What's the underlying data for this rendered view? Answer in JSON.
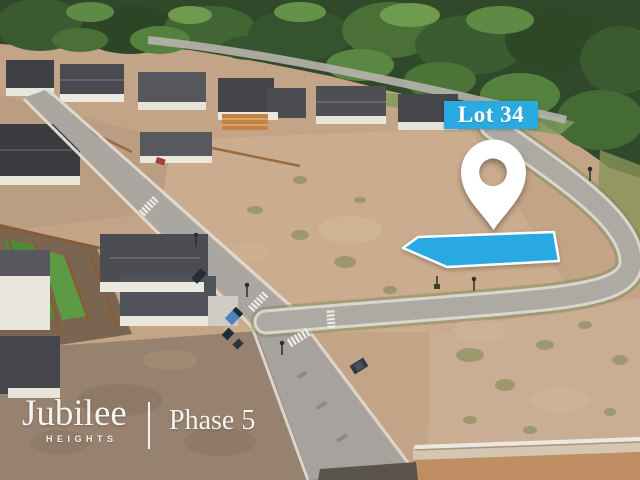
{
  "overlay": {
    "lot_label": "Lot 34",
    "marker": "location-pin"
  },
  "branding": {
    "name": "Jubilee",
    "subtitle": "HEIGHTS",
    "phase": "Phase 5"
  },
  "colors": {
    "highlight_blue": "#29a9e1",
    "label_blue": "#2baae1",
    "label_text": "#ffffff",
    "marker_white": "#ffffff",
    "brand_white": "#f5f3ee"
  },
  "scene": {
    "description": "Aerial drone photo of a residential subdivision under development: forested hillside at top, a row of finished homes, curving new roads with crosswalks, and graded empty dirt lots; Lot 34 is highlighted in blue with a white map pin"
  }
}
